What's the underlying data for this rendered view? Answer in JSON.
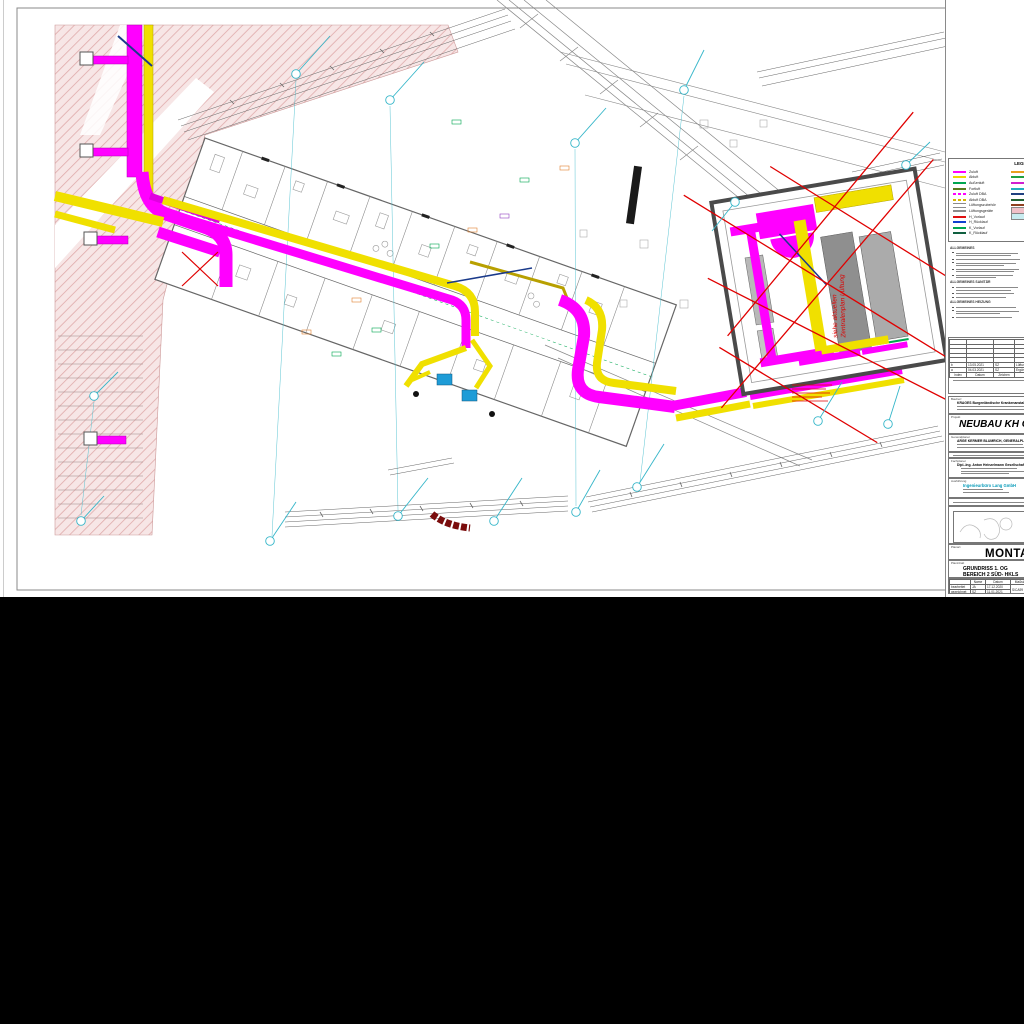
{
  "sheet": {
    "legend": {
      "title": "LEGENDE-HKLS",
      "left_entries": [
        {
          "label": "Zuluft",
          "color": "#ff00ff",
          "style": "solid"
        },
        {
          "label": "Abluft",
          "color": "#f0d800",
          "style": "solid"
        },
        {
          "label": "Außenluft",
          "color": "#00a651",
          "style": "solid"
        },
        {
          "label": "Fortluft",
          "color": "#5a7a1e",
          "style": "solid"
        },
        {
          "label": "Zuluft DBA",
          "color": "#ff00ff",
          "style": "dashed"
        },
        {
          "label": "Abluft DBA",
          "color": "#d8b400",
          "style": "dashed"
        },
        {
          "label": "Lüftungszubehör",
          "color": "#8c8c8c",
          "style": "double"
        },
        {
          "label": "Lüftungsgeräte",
          "color": "#8c8c8c",
          "style": "solid"
        },
        {
          "label": "H_Vorlauf",
          "color": "#e01010",
          "style": "solid"
        },
        {
          "label": "H_Rücklauf",
          "color": "#1040d0",
          "style": "solid"
        },
        {
          "label": "K_Vorlauf",
          "color": "#00a651",
          "style": "solid"
        },
        {
          "label": "K_Rücklauf",
          "color": "#106040",
          "style": "solid"
        }
      ],
      "right_entries": [
        {
          "label": "",
          "color": "#e8a020",
          "style": "solid"
        },
        {
          "label": "",
          "color": "#20a040",
          "style": "solid"
        },
        {
          "label": "",
          "color": "#d020d0",
          "style": "solid"
        },
        {
          "label": "",
          "color": "#20b0c0",
          "style": "solid"
        },
        {
          "label": "",
          "color": "#204080",
          "style": "solid"
        },
        {
          "label": "",
          "color": "#206030",
          "style": "solid"
        },
        {
          "label": "",
          "color": "#904020",
          "style": "solid"
        },
        {
          "label": "",
          "color": "#f0c0c8",
          "style": "fill"
        },
        {
          "label": "",
          "color": "#c8ecf0",
          "style": "fill"
        }
      ]
    },
    "notes": {
      "general": "ALLGEMEINES",
      "sanitary": "ALLGEMEINES SANITÄR",
      "heating": "ALLGEMEINES HEIZUNG"
    },
    "revisions": {
      "headers": [
        "Index",
        "Datum",
        "Zeichen",
        "Änderung"
      ],
      "rows": [
        {
          "index": "b",
          "date": "13.05.2021",
          "sign": "SZ",
          "change": "Lüftungszentrale angepasst"
        },
        {
          "index": "a",
          "date": "04.03.2021",
          "sign": "SZ",
          "change": "Ergänzungen"
        }
      ]
    },
    "owner": {
      "label": "Bauherr",
      "name": "KRAGES Burgenländische Krankenanstalten-Ges.m.b.H."
    },
    "project": {
      "label": "Projekt",
      "name": "NEUBAU KH OBERWART"
    },
    "planner": {
      "label": "Generalplaner",
      "name": "ARGE KERMER BLUMRICH, GENERALPLANUNG"
    },
    "engineer": {
      "label": "Fachplaner",
      "name": "Dipl.-Ing. Anton Heinzelmann Gesellschaft m.b.H."
    },
    "contractor": {
      "label": "Ausführung",
      "name": "Ingenieurbüro Lang GmbH",
      "accent_color": "#0a9cba"
    },
    "plan_title": "MONTAGEPLAN",
    "content": {
      "label": "Planinhalt",
      "line1": "GRUNDRISS 1. OG",
      "line2": "BEREICH 2 SÜD- HKLS"
    },
    "meta": {
      "col_name": "Name",
      "col_date": "Datum",
      "col_scale": "Maßstab",
      "col_trade": "Gew.",
      "row1_label": "bearbeitet",
      "row1_name": "JA",
      "row1_date": "17.12.2020",
      "row2_label": "gezeichnet",
      "row2_name": "SZ",
      "row2_date": "11.01.2021",
      "scale": "S/CA99",
      "trade": "HKL"
    },
    "plan_annotations": {
      "tech_note_line1": "siehe aktuellen",
      "tech_note_line2": "Zentralenplan Lüftung"
    }
  }
}
